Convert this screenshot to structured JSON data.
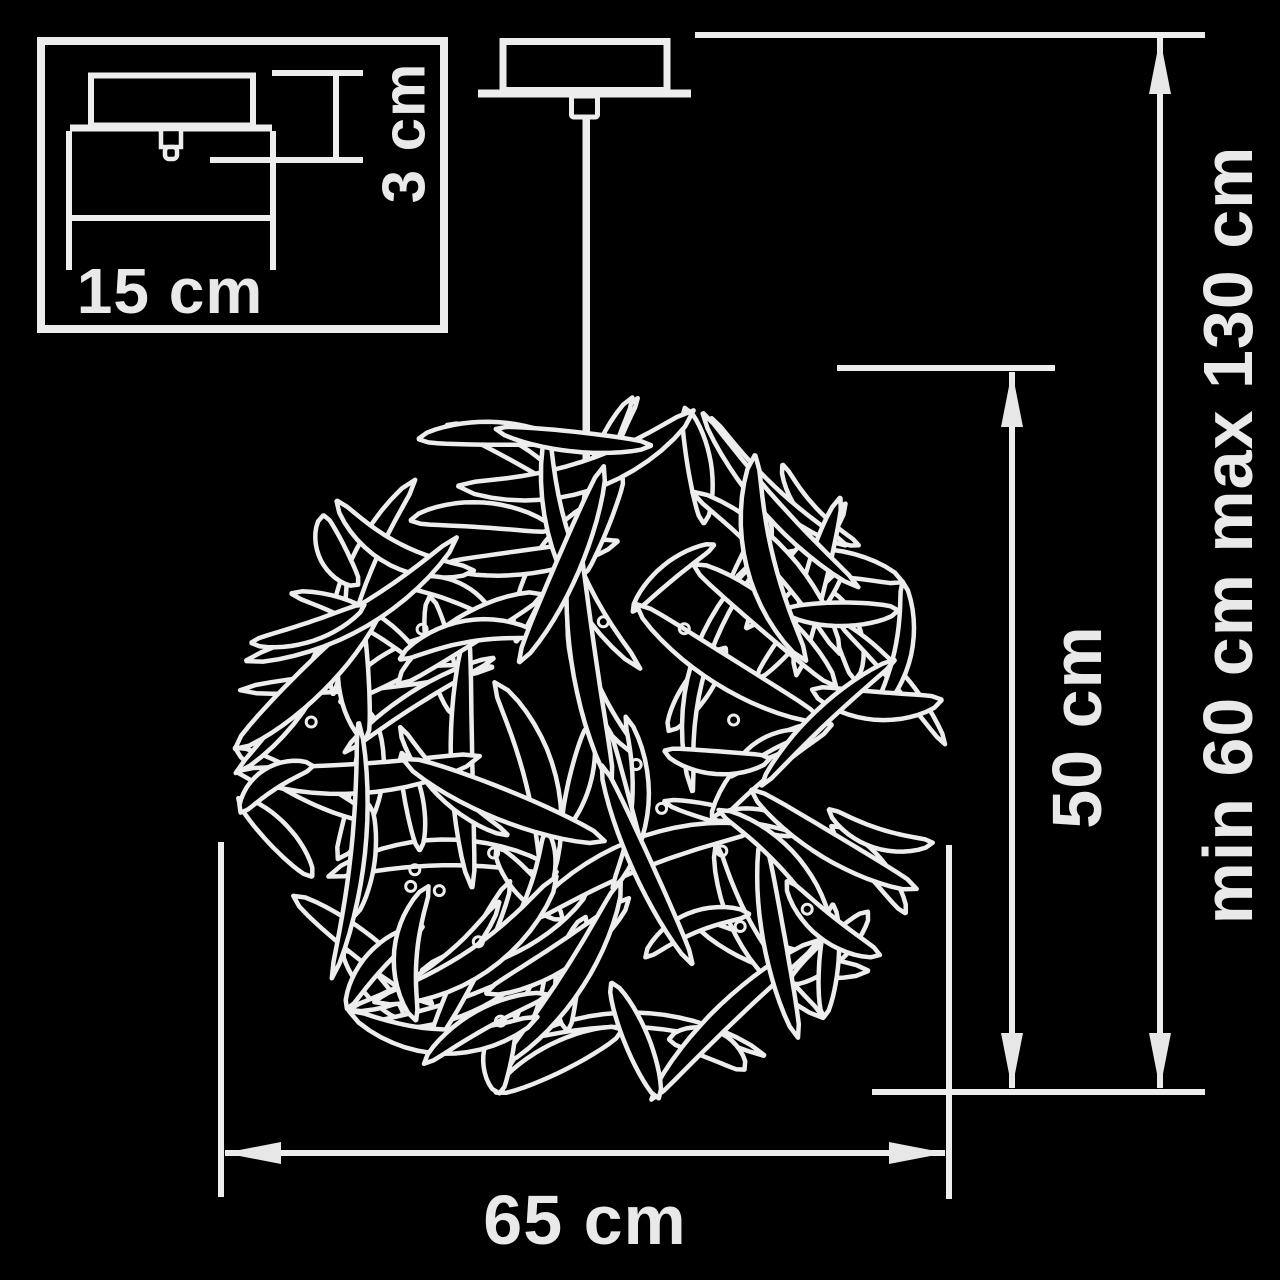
{
  "diagram": {
    "labels": {
      "canopy_width": "15 cm",
      "canopy_height": "3 cm",
      "shade_height": "50 cm",
      "suspension_range": "min 60 cm max 130 cm",
      "shade_width": "65 cm"
    },
    "colors": {
      "background": "#000000",
      "line": "#ededed",
      "text": "#e9e9e9"
    },
    "tangle": {
      "center_x": 590,
      "center_y": 750,
      "radius": 355,
      "ribbon_count": 110,
      "screw_dot_count": 16
    }
  }
}
